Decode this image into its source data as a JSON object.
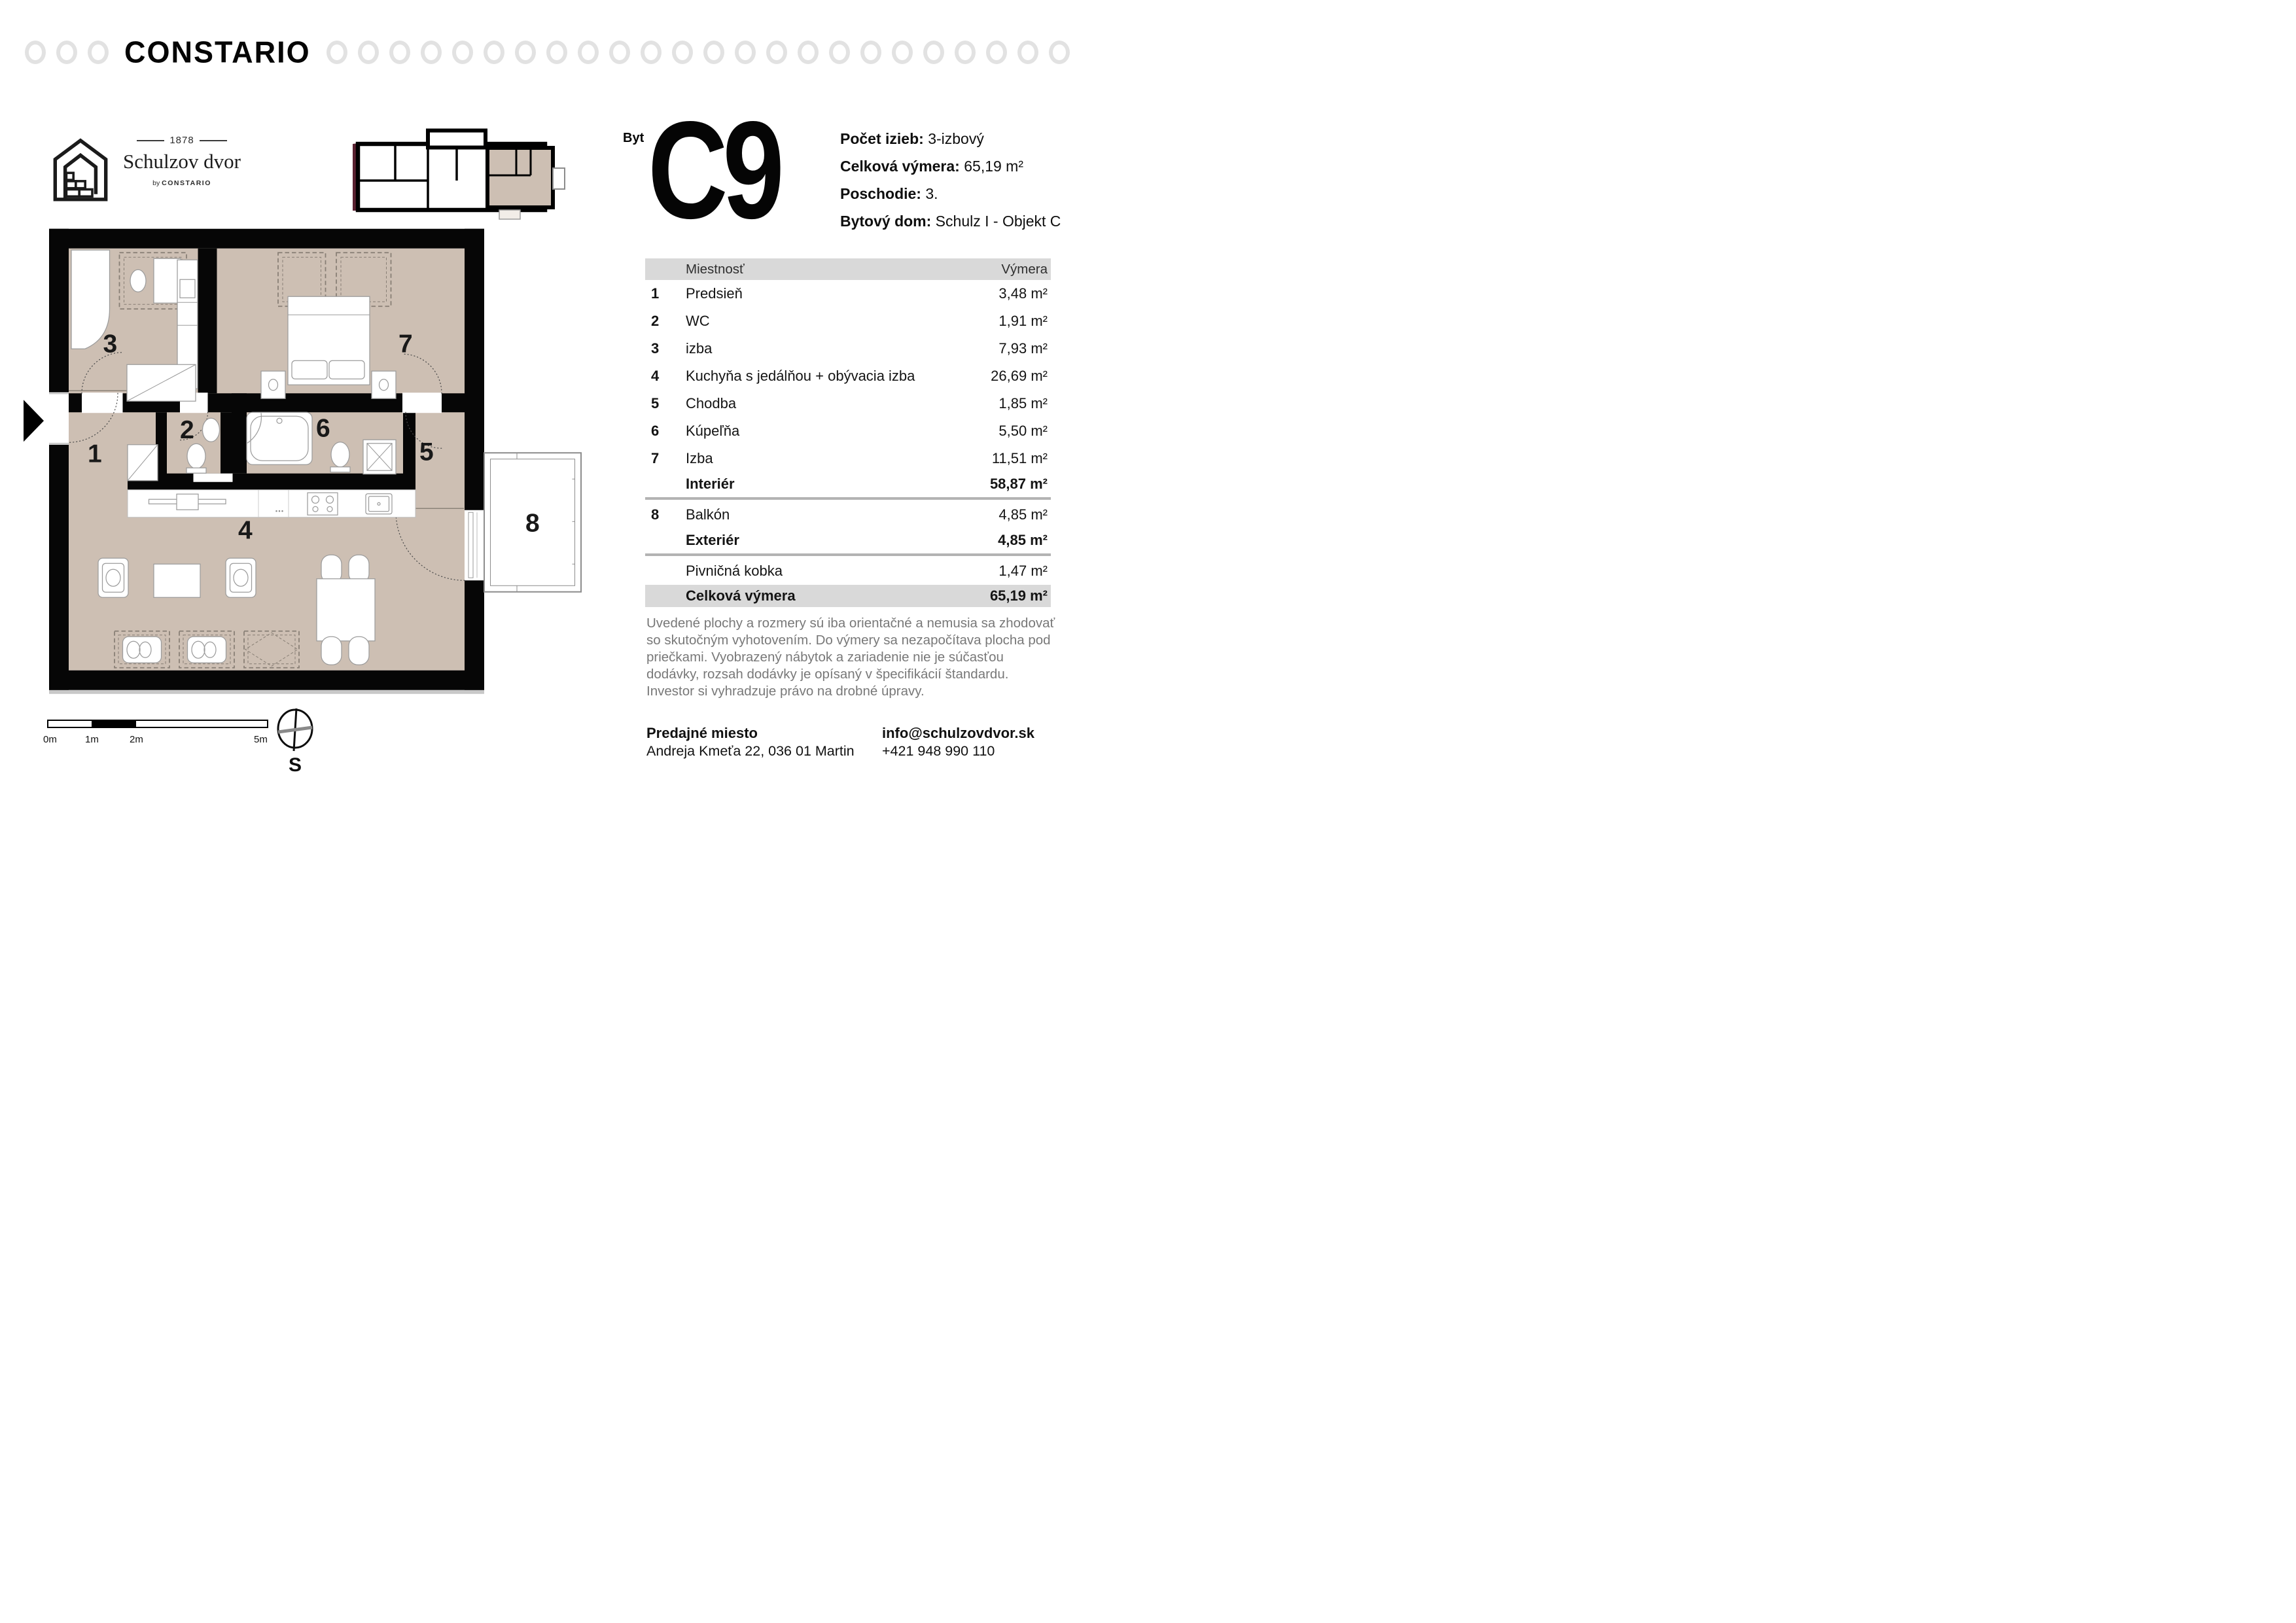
{
  "brand": {
    "name": "CONSTARIO"
  },
  "logo": {
    "year": "1878",
    "name": "Schulzov dvor",
    "by_prefix": "by",
    "by_brand": "CONSTARIO"
  },
  "unit": {
    "label": "Byt",
    "code": "C9",
    "details": [
      {
        "label": "Počet izieb:",
        "value": "3-izbový"
      },
      {
        "label": "Celková výmera:",
        "value": "65,19 m²"
      },
      {
        "label": "Poschodie:",
        "value": "3."
      },
      {
        "label": "Bytový dom:",
        "value": "Schulz I - Objekt C"
      }
    ]
  },
  "table": {
    "headers": {
      "room": "Miestnosť",
      "area": "Výmera"
    },
    "rows": [
      {
        "num": "1",
        "name": "Predsieň",
        "area": "3,48 m²"
      },
      {
        "num": "2",
        "name": "WC",
        "area": "1,91 m²"
      },
      {
        "num": "3",
        "name": "izba",
        "area": "7,93 m²"
      },
      {
        "num": "4",
        "name": "Kuchyňa s jedálňou + obývacia izba",
        "area": "26,69 m²"
      },
      {
        "num": "5",
        "name": "Chodba",
        "area": "1,85 m²"
      },
      {
        "num": "6",
        "name": "Kúpeľňa",
        "area": "5,50 m²"
      },
      {
        "num": "7",
        "name": "Izba",
        "area": "11,51 m²"
      }
    ],
    "interior": {
      "label": "Interiér",
      "area": "58,87 m²"
    },
    "exterior_rows": [
      {
        "num": "8",
        "name": "Balkón",
        "area": "4,85 m²"
      }
    ],
    "exterior": {
      "label": "Exteriér",
      "area": "4,85 m²"
    },
    "cellar": {
      "name": "Pivničná kobka",
      "area": "1,47 m²"
    },
    "total": {
      "label": "Celková výmera",
      "area": "65,19 m²"
    }
  },
  "disclaimer": "Uvedené plochy a rozmery sú iba orientačné a nemusia sa zhodovať\nso skutočným vyhotovením. Do výmery sa nezapočítava plocha pod\npriečkami. Vyobrazený nábytok a zariadenie nie je súčasťou\ndodávky, rozsah dodávky je opísaný v špecifikácií štandardu.\nInvestor si vyhradzuje právo na drobné úpravy.",
  "contact": {
    "sales_label": "Predajné miesto",
    "address": "Andreja Kmeťa 22, 036 01 Martin",
    "email": "info@schulzovdvor.sk",
    "phone": "+421 948 990 110"
  },
  "plan": {
    "labels": [
      "1",
      "2",
      "3",
      "4",
      "5",
      "6",
      "7",
      "8"
    ],
    "scale_labels": [
      "0m",
      "1m",
      "2m",
      "5m"
    ],
    "compass_label": "S"
  },
  "colors": {
    "floor": "#cdbfb3",
    "wall": "#060606",
    "maroon_accent": "#5a2130",
    "table_header_bg": "#d9d9d9",
    "divider": "#b3b3b3",
    "disclaimer_text": "#787878",
    "ring": "#e2e2e2"
  }
}
